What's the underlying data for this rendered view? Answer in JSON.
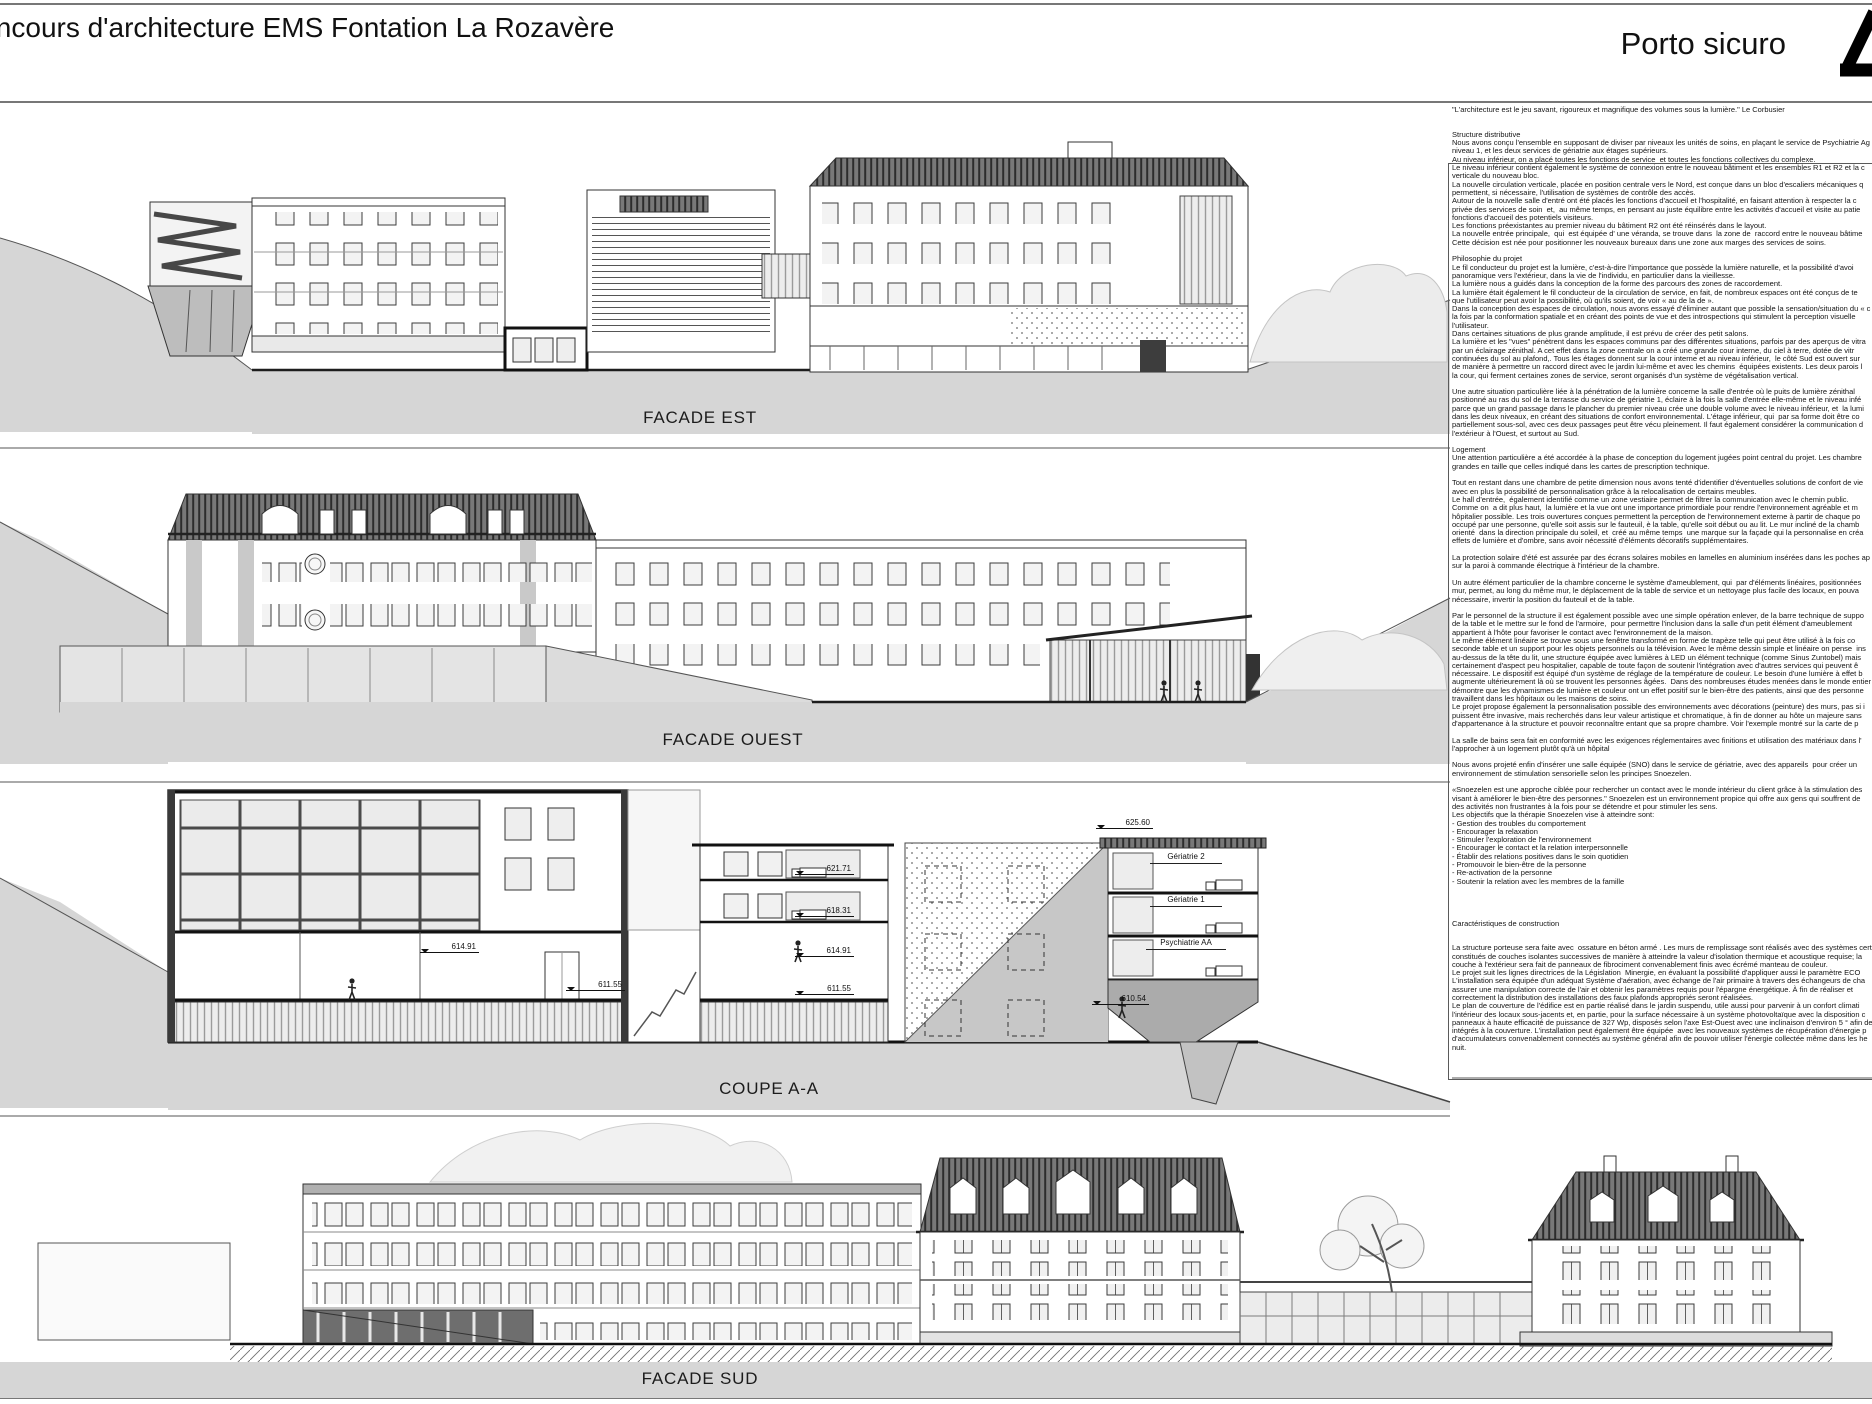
{
  "header": {
    "title": "Concours d'architecture EMS Fontation La Rozavère",
    "project_name": "Porto sicuro",
    "logo_icon": "triangle-logo"
  },
  "drawings": {
    "facade_est": {
      "label": "FACADE EST"
    },
    "facade_ouest": {
      "label": "FACADE OUEST"
    },
    "coupe_aa": {
      "label": "COUPE A-A",
      "rooms": [
        "Gériatrie 2",
        "Gériatrie 1",
        "Psychiatrie AA"
      ],
      "elevations": {
        "roof": "625.60",
        "l3": "621.71",
        "l2": "618.31",
        "l1_right": "614.91",
        "l0_right": "611.55",
        "l1_left": "614.91",
        "l0_left": "611.55",
        "base": "610.54"
      }
    },
    "facade_sud": {
      "label": "FACADE SUD"
    }
  },
  "description": {
    "quote": "\"L'architecture est le jeu savant, rigoureux et magnifique des volumes sous la lumière.\" Le Corbusier",
    "sections": [
      {
        "heading": "Structure distributive",
        "body": "Nous avons conçu l'ensemble en supposant de diviser par niveaux les unités de soins, en plaçant le service de Psychiatrie Ag\nniveau 1, et les deux services de gériatrie aux étages supérieurs.\nAu niveau inférieur, on a placé toutes les fonctions de service  et toutes les fonctions collectives du complexe.\nLe niveau inférieur contient également le système de connexion entre le nouveau bâtiment et les ensembles R1 et R2 et la c\nverticale du nouveau bloc.\nLa nouvelle circulation verticale, placée en position centrale vers le Nord, est conçue dans un bloc d'escaliers mécaniques q\npermettent, si nécessaire, l'utilisation de systèmes de contrôle des accès.\nAutour de la nouvelle salle d'entré ont été placés les fonctions d'accueil et l'hospitalité, en faisant attention à respecter la c\nprivée des services de soin  et,  au même temps, en pensant au juste équilibre entre les activités d'accueil et visite au patie\nfonctions d'accueil des potentiels visiteurs.\nLes fonctions préexistantes au premier niveau du bâtiment R2 ont été réinsérés dans le layout.\nLa nouvelle entrée principale,  qui  est équipée d' une véranda, se trouve dans  la zone de  raccord entre le nouveau bâtime\nCette décision est née pour positionner les nouveaux bureaux dans une zone aux marges des services de soins."
      },
      {
        "heading": "Philosophie du projet",
        "body": "Le fil conducteur du projet est la lumière, c'est-à-dire l'importance que possède la lumière naturelle, et la possibilité d'avoi\npanoramique vers l'extérieur, dans la vie de l'individu, en particulier dans la vieillesse.\nLa lumière nous a guidés dans la conception de la forme des parcours des zones de raccordement.\nLa lumière était également le fil conducteur de la circulation de service, en fait, de nombreux espaces ont été conçus de te\nque l'utilisateur peut avoir la possibilité, où qu'ils soient, de voir « au de la de ».\nDans la conception des espaces de circulation, nous avons essayé d'éliminer autant que possible la sensation/situation du « c\nla fois par la conformation spatiale et en créant des points de vue et des introspections qui stimulent la perception visuelle\nl'utilisateur.\nDans certaines situations de plus grande amplitude, il est prévu de créer des petit salons.\nLa lumière et les \"vues\" pénètrent dans les espaces communs par des différentes situations, parfois par des aperçus de vitra\npar un éclairage zénithal. A cet effet dans la zone centrale on a créé une grande cour interne, du ciel à terre, dotée de vitr\ncontinuées du sol au plafond,. Tous les étages donnent sur la cour interne et au niveau inférieur,  le côté Sud est ouvert sur\nde manière à permettre un raccord direct avec le jardin lui-même et avec les chemins  équipées existents. Les deux parois l\nla cour, qui ferment certaines zones de service, seront organisés d'un système de végétalisation vertical.\n\nUne autre situation particulière liée à la pénétration de la lumière concerne la salle d'entrée où le puits de lumière zénithal\npositionné au ras du sol de la terrasse du service de gériatrie 1, éclaire à la fois la salle d'entrée elle-même et le niveau infé\nparce que un grand passage dans le plancher du premier niveau crée une double volume avec le niveau inférieur, et  la lumi\ndans les deux niveaux, en créant des situations de confort environnemental. L'étage inférieur, qui  par sa forme doit être co\npartiellement sous-sol, avec ces deux passages peut être vécu pleinement. Il faut également considérer la communication d\nl'extérieur à l'Ouest, et surtout au Sud."
      },
      {
        "heading": "Logement",
        "body": "Une attention particulière a été accordée à la phase de conception du logement jugées point central du projet. Les chambre\ngrandes en taille que celles indiqué dans les cartes de prescription technique.\n\nTout en restant dans une chambre de petite dimension nous avons tenté d'identifier d'éventuelles solutions de confort de vie\navec en plus la possibilité de personnalisation grâce à la relocalisation de certains meubles.\nLe hall d'entrée,  également identifié comme un zone vestiaire permet de filtrer la communication avec le chemin public.\nComme on  a dit plus haut,  la lumière et la vue ont une importance primordiale pour rendre l'environnement agréable et m\nhôpitalier possible. Les trois ouvertures conçues permettent la perception de l'environnement externe à partir de chaque po\noccupé par une personne, qu'elle soit assis sur le fauteuil, è la table, qu'elle soit début ou au lit. Le mur incliné de la chamb\norienté  dans la direction principale du soleil, et  créé au même temps  une marque sur la façade qui la personnalise en créa\neffets de lumière et d'ombre, sans avoir nécessité d'éléments décoratifs supplémentaires.\n\nLa protection solaire d'été est assurée par des écrans solaires mobiles en lamelles en aluminium insérées dans les poches ap\nsur la paroi à commande électrique à l'intérieur de la chambre.\n\nUn autre élément particulier de la chambre concerne le système d'ameublement, qui  par d'éléments linéaires, positionnées\nmur, permet, au long du même mur, le déplacement de la table de service et un nettoyage plus facile des locaux, en pouva\nnécessaire, invertir la position du fauteuil et de la table.\n\nPar le personnel de la structure il est également possible avec une simple opération enlever, de la barre technique de suppo\nde la table et le mettre sur le fond de l'armoire,  pour permettre l'inclusion dans la salle d'un petit élément d'ameublement\nappartient à l'hôte pour favoriser le contact avec l'environnement de la maison.\nLe même élément linéaire se trouve sous une fenêtre transformé en forme de trapèze telle qui peut être utilisé à la fois co\nseconde table et un support pour les objets personnels ou la télévision. Avec le même dessin simple et linéaire on pense  ins\nau-dessus de la tête du lit, une structure équipée avec lumières à LED un élément technique (comme Sinus Zuntobel) mais\ncertainement d'aspect peu hospitalier, capable de toute façon de soutenir l'intégration avec d'autres services qui peuvent ê\nnécessaire. Le dispositif est équipé d'un système de réglage de la température de couleur. Le besoin d'une lumière à effet b\naugmente ultérieurement là où se trouvent les personnes âgées.  Dans des nombreuses études menées dans le monde entier\ndémontre que les dynamismes de lumière et couleur ont un effet positif sur le bien-être des patients, ainsi que des personne\ntravaillent dans les hôpitaux ou les maisons de soins.\nLe projet propose également la personnalisation possible des environnements avec décorations (peinture) des murs, pas si i\npuissent être invasive, mais recherchés dans leur valeur artistique et chromatique, à fin de donner au hôte un majeure sans\nd'appartenance à la structure et pouvoir reconnaître entant que sa propre chambre. Voir l'exemple montré sur la carte de p\n\nLa salle de bains sera fait en conformité avec les exigences réglementaires avec finitions et utilisation des matériaux dans l'\nl'approcher à un logement plutôt qu'à un hôpital\n\nNous avons projeté enfin d'insérer une salle équipée (SNO) dans le service de gériatrie, avec des appareils  pour créer un\nenvironnement de stimulation sensorielle selon les principes Snoezelen.\n\n«Snoezelen est une approche ciblée pour rechercher un contact avec le monde intérieur du client grâce à la stimulation des\nvisant à améliorer le bien-être des personnes.\" Snoezelen est un environnement propice qui offre aux gens qui souffrent de\ndes activités non frustrantes à la fois pour se détendre et pour stimuler les sens.\nLes objectifs que la thérapie Snoezelen vise à atteindre sont:\n- Gestion des troubles du comportement\n- Encourager la relaxation\n- Stimuler l'exploration de l'environnement\n- Encourager le contact et la relation interpersonnelle\n- Établir des relations positives dans le soin quotidien\n- Promouvoir le bien-être de la personne\n- Re-activation de la personne\n- Soutenir la relation avec les membres de la famille"
      },
      {
        "heading": "Caractéristiques de construction",
        "body": "La structure porteuse sera faite avec  ossature en béton armé . Les murs de remplissage sont réalisés avec des systèmes cert\nconstitués de couches isolantes successives de manière à atteindre la valeur d'isolation thermique et acoustique requise; la\ncouche à l'extérieur sera fait de panneaux de fibrociment convenablement finis avec écrémé manteau de couleur.\nLe projet suit les lignes directrices de la Législation  Minergie, en évaluant la possibilité d'appliquer aussi le paramètre ECO\nL'installation sera équipée d'un adéquat Système d'aération, avec échange de l'air primaire à travers des échangeurs de cha\nassurer une manipulation correcte de l'air et obtenir les paramètres requis pour l'épargne énergétique. À fin de réaliser et\ncorrectement la distribution des installations des faux plafonds appropriés seront réalisées.\nLe plan de couverture de l'édifice est en partie réalisé dans le jardin suspendu, utile aussi pour parvenir à un confort climati\nl'intérieur des locaux sous-jacents et, en partie, pour la surface nécessaire à un système photovoltaïque avec la disposition c\npanneaux à haute efficacité de puissance de 327 Wp, disposés selon l'axe Est-Ouest avec une inclinaison d'environ 5 ° afin de\nintégrés à la couverture. L'installation peut également être équipée  avec les nouveaux systèmes de récupération d'énergie p\nd'accumulateurs convenablement connectés au système général afin de pouvoir utiliser l'énergie collectée même dans les he\nnuit."
      }
    ]
  }
}
